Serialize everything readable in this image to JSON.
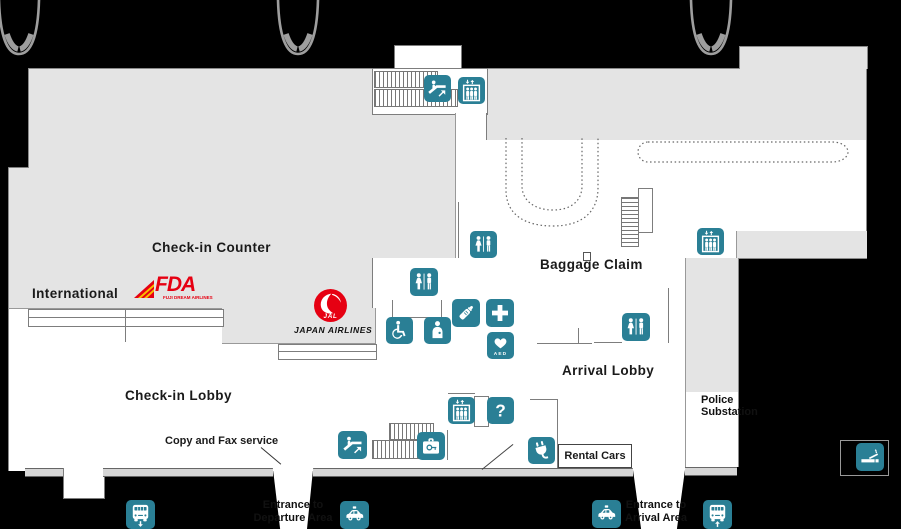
{
  "colors": {
    "icon_teal": "#2a7f95",
    "floor_gray": "#e4e4e4",
    "wall_gray": "#7d7d7d",
    "background": "#000000",
    "fda_red": "#e60012",
    "fda_yellow": "#f9be00",
    "jal_red": "#e60012"
  },
  "areas": {
    "check_in_counter": "Check-in Counter",
    "international": "International",
    "check_in_lobby": "Check-in Lobby",
    "baggage_claim": "Baggage Claim",
    "arrival_lobby": "Arrival Lobby"
  },
  "annotations": {
    "copy_fax": "Copy and Fax service",
    "rental_cars": "Rental Cars",
    "police": {
      "line1": "Police",
      "line2": "Substation"
    },
    "entrance_departure": {
      "line1": "Entrance to",
      "line2": "Departure Area"
    },
    "entrance_arrival": {
      "line1": "Entrance to",
      "line2": "Arrival Area"
    }
  },
  "logos": {
    "fda": {
      "name": "FDA",
      "caption": "FUJI DREAM AIRLINES"
    },
    "jal": {
      "name": "JAL",
      "caption": "JAPAN AIRLINES"
    }
  },
  "icons": {
    "aed_label": "AED",
    "help_mark": "?",
    "names": [
      "escalator-up-icon",
      "elevator-icon",
      "toilet-icon",
      "wheelchair-toilet-icon",
      "nursing-room-icon",
      "baby-bottle-icon",
      "first-aid-icon",
      "aed-icon",
      "information-icon",
      "coin-locker-icon",
      "charging-plug-icon",
      "smoking-area-icon",
      "bus-stop-icon",
      "taxi-stand-icon"
    ]
  }
}
